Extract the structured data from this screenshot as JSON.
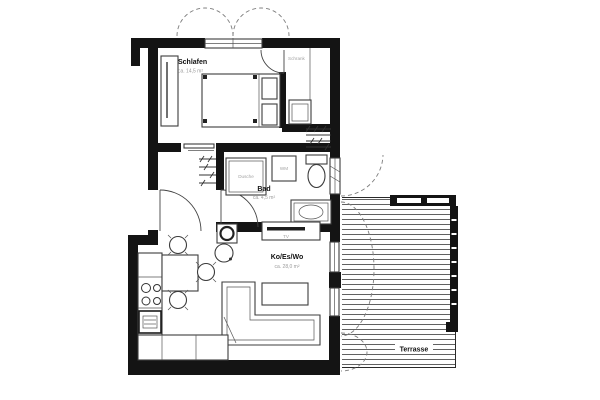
{
  "plan": {
    "title": "apartment-floor-plan",
    "rooms": {
      "bedroom": {
        "label": "Schlafen",
        "area": "ca. 14,5 m²"
      },
      "closet": {
        "label": "Schrank"
      },
      "bath": {
        "label": "Bad",
        "area": "ca. 4,5 m²"
      },
      "living": {
        "label": "Ko/Es/Wo",
        "area": "ca. 28,0 m²"
      },
      "terrace": {
        "label": "Terrasse"
      }
    },
    "fixtures": {
      "shower": "Dusche",
      "washer": "WM",
      "tv": "TV"
    }
  },
  "colors": {
    "wall": "#141414",
    "furniture_line": "#3c3c3c",
    "muted_text": "#9b9b9b",
    "deck_line": "#4f4f4f",
    "background": "#ffffff"
  }
}
